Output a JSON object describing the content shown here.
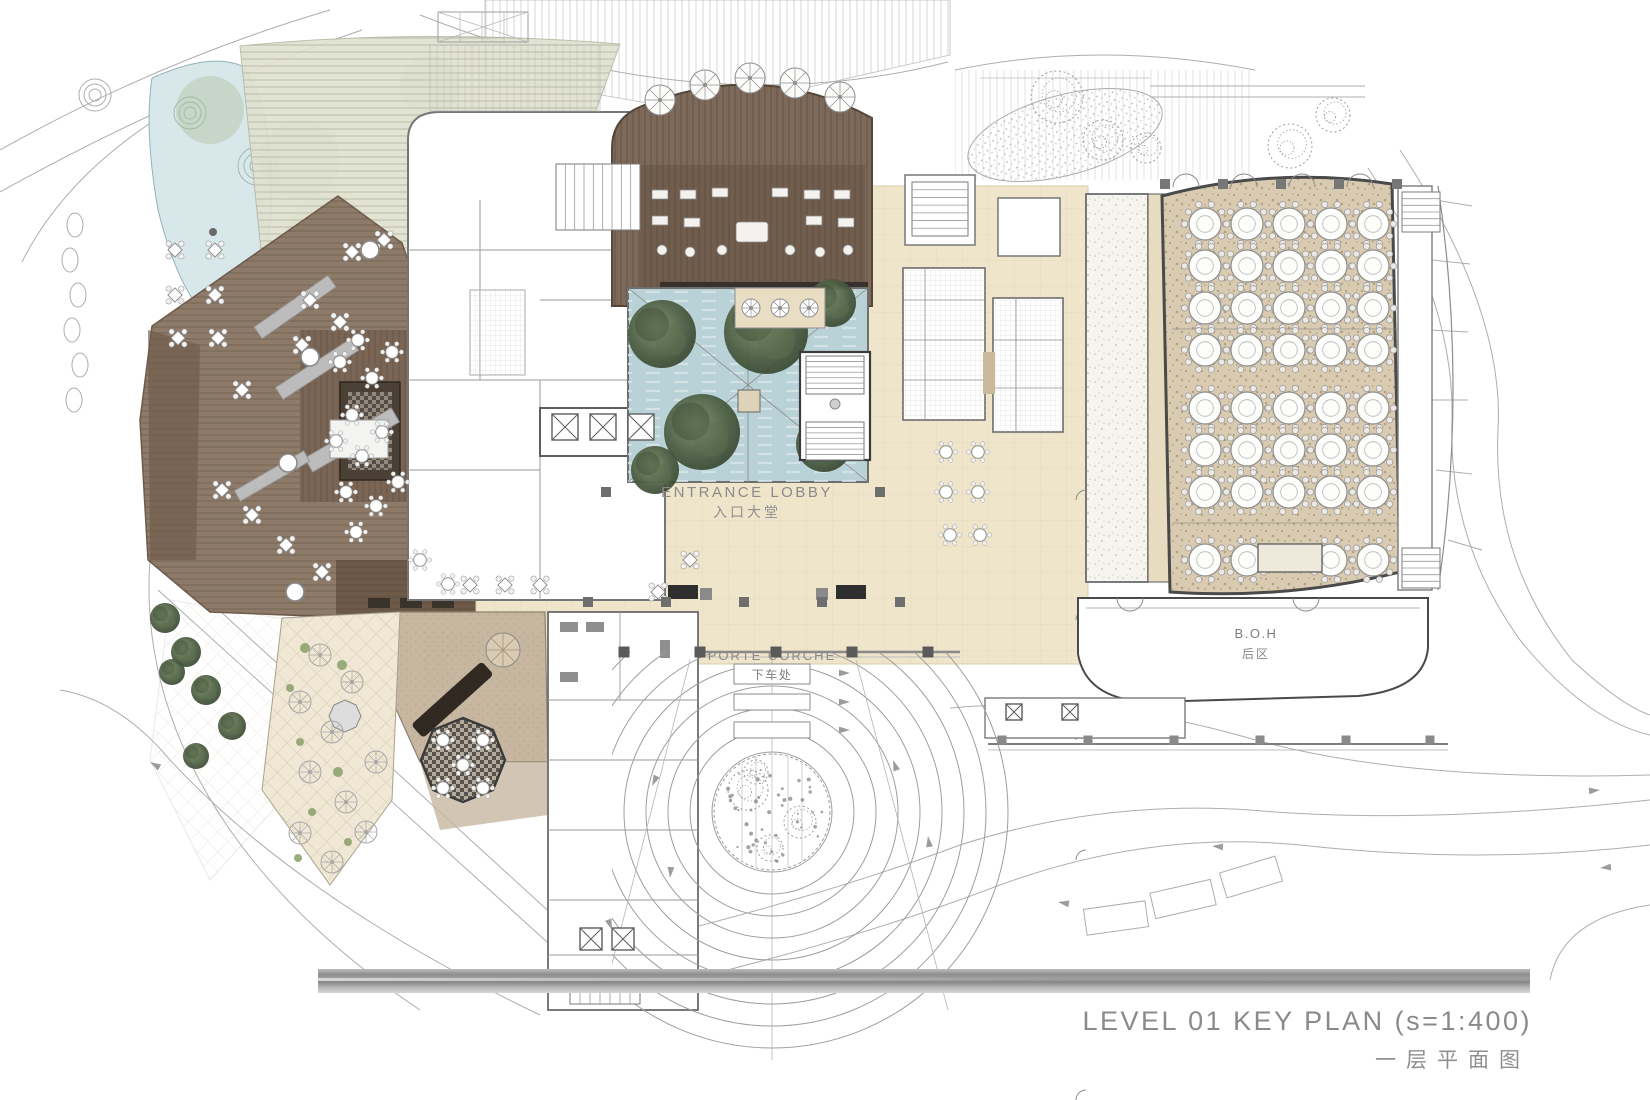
{
  "title_block": {
    "title": "LEVEL 01 KEY PLAN (s=1:400)",
    "subtitle": "一层平面图"
  },
  "labels": {
    "entrance_lobby": {
      "en": "ENTRANCE LOBBY",
      "cn": "入口大堂"
    },
    "porte_cochere": {
      "en": "PORTE CORCHE",
      "cn": "下车处"
    },
    "boh": {
      "en": "B.O.H",
      "cn": "后区"
    }
  },
  "areas": [
    {
      "name": "pond",
      "fill": "#d8e7ea"
    },
    {
      "name": "boardwalk",
      "fill": "#e0e1d0"
    },
    {
      "name": "outdoor-deck",
      "fill": "#8e7a68"
    },
    {
      "name": "all-day-dining-floor",
      "fill": "#7a6554"
    },
    {
      "name": "lounge-bar-floor",
      "fill": "#75614f"
    },
    {
      "name": "lobby-floor",
      "fill": "#efe5cb"
    },
    {
      "name": "courtyard-water",
      "fill": "#b9d2d7"
    },
    {
      "name": "banquet-carpet",
      "fill": "#d9ccb4"
    },
    {
      "name": "pre-function-carpet",
      "fill": "#f5f3ee"
    },
    {
      "name": "specialty-restaurant-floor",
      "fill": "#c7b6a0"
    },
    {
      "name": "terrace-paving",
      "fill": "#f0e8d4"
    },
    {
      "name": "wall-stroke",
      "fill": "#4a4a4a"
    },
    {
      "name": "linework-stroke",
      "fill": "#a9a9a9"
    },
    {
      "name": "title-text",
      "fill": "#8a8a8a"
    }
  ],
  "render": {
    "banquet": {
      "cols": [
        1205,
        1247,
        1289,
        1331,
        1373
      ],
      "rows": [
        224,
        266,
        308,
        350,
        408,
        450,
        492
      ],
      "bottom_row": {
        "y": 560,
        "cols": [
          1205,
          1247,
          1331,
          1373
        ]
      },
      "table_r": 16
    },
    "porte_cochere": {
      "cx": 772,
      "cy": 812,
      "radii": [
        38,
        60,
        82,
        104,
        126,
        148,
        170,
        192,
        214,
        236
      ],
      "tree_r": 58
    },
    "parasols": {
      "large": [
        [
          660,
          100
        ],
        [
          705,
          85
        ],
        [
          750,
          78
        ],
        [
          795,
          83
        ],
        [
          840,
          97
        ]
      ],
      "r_large": 15,
      "small": [
        [
          751,
          308
        ],
        [
          780,
          308
        ],
        [
          809,
          308
        ]
      ],
      "r_small": 9,
      "sketch": [
        [
          320,
          655
        ],
        [
          352,
          682
        ],
        [
          300,
          702
        ],
        [
          332,
          732
        ],
        [
          310,
          772
        ],
        [
          346,
          802
        ],
        [
          300,
          833
        ],
        [
          332,
          862
        ],
        [
          366,
          832
        ],
        [
          376,
          762
        ]
      ],
      "r_sketch": 11
    },
    "diamond_tables": [
      [
        175,
        250
      ],
      [
        215,
        250
      ],
      [
        175,
        295
      ],
      [
        215,
        295
      ],
      [
        178,
        338
      ],
      [
        218,
        338
      ],
      [
        242,
        390
      ],
      [
        310,
        300
      ],
      [
        340,
        322
      ],
      [
        302,
        345
      ],
      [
        352,
        252
      ],
      [
        384,
        240
      ],
      [
        222,
        490
      ],
      [
        252,
        515
      ],
      [
        286,
        545
      ],
      [
        322,
        572
      ],
      [
        470,
        585
      ],
      [
        505,
        585
      ],
      [
        540,
        585
      ],
      [
        658,
        592
      ],
      [
        690,
        560
      ]
    ],
    "round_tables": [
      [
        358,
        340
      ],
      [
        392,
        352
      ],
      [
        372,
        378
      ],
      [
        340,
        362
      ],
      [
        352,
        415
      ],
      [
        382,
        432
      ],
      [
        362,
        456
      ],
      [
        336,
        441
      ],
      [
        346,
        492
      ],
      [
        376,
        506
      ],
      [
        356,
        532
      ],
      [
        398,
        482
      ],
      [
        420,
        560
      ],
      [
        448,
        584
      ],
      [
        443,
        740
      ],
      [
        483,
        740
      ],
      [
        463,
        765
      ],
      [
        443,
        788
      ],
      [
        483,
        788
      ],
      [
        946,
        452
      ],
      [
        978,
        452
      ],
      [
        946,
        492
      ],
      [
        978,
        492
      ],
      [
        950,
        535
      ],
      [
        980,
        535
      ]
    ],
    "trees_dark": [
      [
        662,
        334,
        34
      ],
      [
        702,
        432,
        38
      ],
      [
        766,
        332,
        42
      ],
      [
        832,
        303,
        24
      ],
      [
        824,
        444,
        28
      ],
      [
        655,
        470,
        24
      ],
      [
        165,
        618,
        15
      ],
      [
        186,
        652,
        15
      ],
      [
        206,
        690,
        15
      ],
      [
        172,
        672,
        13
      ],
      [
        232,
        726,
        14
      ],
      [
        196,
        756,
        13
      ]
    ],
    "green_washes": [
      [
        300,
        160,
        40
      ],
      [
        330,
        240,
        45
      ],
      [
        282,
        322,
        40
      ],
      [
        252,
        420,
        36
      ],
      [
        300,
        492,
        34
      ],
      [
        210,
        110,
        34
      ],
      [
        690,
        150,
        38
      ],
      [
        790,
        138,
        32
      ],
      [
        430,
        85,
        30
      ]
    ],
    "scribble_trees": [
      [
        1057,
        97,
        26
      ],
      [
        1103,
        140,
        20
      ],
      [
        1146,
        148,
        15
      ],
      [
        1290,
        146,
        22
      ],
      [
        1333,
        115,
        17
      ],
      [
        748,
        790,
        20
      ],
      [
        800,
        822,
        16
      ],
      [
        770,
        848,
        13
      ],
      [
        756,
        772,
        12
      ]
    ],
    "white_columns": [
      [
        370,
        250
      ],
      [
        310,
        357
      ],
      [
        288,
        463
      ],
      [
        295,
        592
      ]
    ],
    "canopy_columns": {
      "y": 652,
      "xs": [
        624,
        700,
        776,
        852,
        928
      ]
    },
    "lobby_columns": [
      [
        588,
        602
      ],
      [
        666,
        602
      ],
      [
        744,
        602
      ],
      [
        822,
        602
      ],
      [
        900,
        602
      ],
      [
        606,
        492
      ],
      [
        880,
        492
      ]
    ],
    "hall_columns": {
      "y": 184,
      "xs": [
        1165,
        1223,
        1281,
        1339,
        1397
      ]
    },
    "boh_columns": {
      "y": 740,
      "xs": [
        1002,
        1088,
        1174,
        1260,
        1346,
        1430
      ]
    },
    "elevators": [
      [
        552,
        414,
        26
      ],
      [
        590,
        414,
        26
      ],
      [
        628,
        414,
        26
      ],
      [
        580,
        928,
        22
      ],
      [
        612,
        928,
        22
      ],
      [
        1006,
        704,
        16
      ],
      [
        1062,
        704,
        16
      ]
    ],
    "stairs": [
      [
        556,
        164,
        84,
        66,
        9,
        "v"
      ],
      [
        570,
        988,
        70,
        16,
        7,
        "v"
      ],
      [
        806,
        356,
        58,
        38,
        7,
        "h"
      ],
      [
        806,
        422,
        58,
        38,
        7,
        "h"
      ],
      [
        912,
        182,
        56,
        54,
        7,
        "h"
      ],
      [
        1402,
        192,
        38,
        40,
        6,
        "h"
      ],
      [
        1402,
        548,
        38,
        40,
        6,
        "h"
      ]
    ],
    "planters": [
      [
        250,
        300,
        90,
        14,
        -35
      ],
      [
        272,
        362,
        90,
        14,
        -33
      ],
      [
        302,
        432,
        100,
        16,
        -30
      ],
      [
        232,
        470,
        80,
        12,
        -30
      ]
    ],
    "arrows": [
      [
        850,
        673,
        0
      ],
      [
        850,
        702,
        0
      ],
      [
        850,
        730,
        0
      ],
      [
        652,
        786,
        115
      ],
      [
        670,
        878,
        95
      ],
      [
        893,
        760,
        250
      ],
      [
        928,
        836,
        262
      ],
      [
        612,
        930,
        70
      ],
      [
        1058,
        902,
        190
      ],
      [
        1212,
        846,
        185
      ],
      [
        1600,
        790,
        355
      ],
      [
        1600,
        868,
        175
      ],
      [
        150,
        762,
        210
      ]
    ],
    "banquet_doors": [
      1186,
      1244,
      1302,
      1360
    ],
    "boh_doors": [
      1130,
      1306
    ],
    "prefunction_doors": [
      245,
      305,
      365,
      425,
      485,
      545
    ]
  }
}
